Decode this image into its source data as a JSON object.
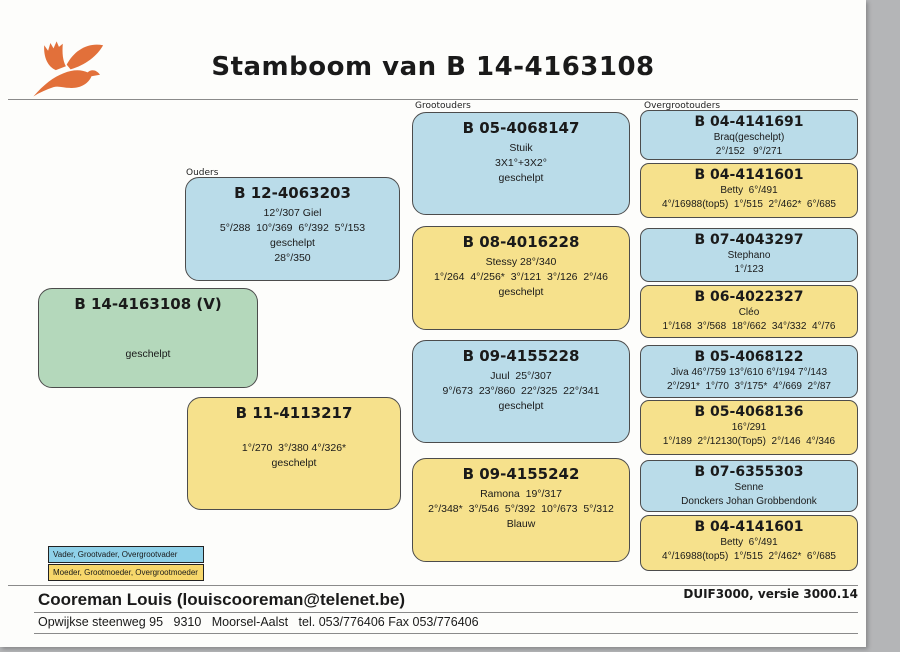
{
  "title": "Stamboom van B 14-4163108",
  "column_labels": {
    "ouders": "Ouders",
    "grootouders": "Grootouders",
    "overgrootouders": "Overgrootouders"
  },
  "subject": {
    "ring": "B 14-4163108 (V)",
    "lines": [
      " ",
      " ",
      "geschelpt"
    ]
  },
  "parents": [
    {
      "role": "vader",
      "ring": "B 12-4063203",
      "lines": [
        "12°/307 Giel",
        "5°/288  10°/369  6°/392  5°/153",
        "geschelpt",
        "28°/350"
      ]
    },
    {
      "role": "moeder",
      "ring": "B 11-4113217",
      "lines": [
        " ",
        "1°/270  3°/380 4°/326*",
        "geschelpt"
      ]
    }
  ],
  "grandparents": [
    {
      "role": "grootvader",
      "ring": "B 05-4068147",
      "lines": [
        "Stuik",
        "3X1°+3X2°",
        "geschelpt"
      ]
    },
    {
      "role": "grootmoeder",
      "ring": "B 08-4016228",
      "lines": [
        "Stessy 28°/340",
        "1°/264  4°/256*  3°/121  3°/126  2°/46",
        "geschelpt"
      ]
    },
    {
      "role": "grootvader",
      "ring": "B 09-4155228",
      "lines": [
        "Juul  25°/307",
        "9°/673  23°/860  22°/325  22°/341",
        "geschelpt"
      ]
    },
    {
      "role": "grootmoeder",
      "ring": "B 09-4155242",
      "lines": [
        "Ramona  19°/317",
        "2°/348*  3°/546  5°/392  10°/673  5°/312",
        "Blauw"
      ]
    }
  ],
  "great_grandparents": [
    {
      "role": "overgrootvader",
      "ring": "B 04-4141691",
      "lines": [
        "Braq(geschelpt)",
        "2°/152   9°/271"
      ]
    },
    {
      "role": "overgrootmoeder",
      "ring": "B 04-4141601",
      "lines": [
        "Betty  6°/491",
        "4°/16988(top5)  1°/515  2°/462*  6°/685"
      ]
    },
    {
      "role": "overgrootvader",
      "ring": "B 07-4043297",
      "lines": [
        "Stephano",
        "1°/123"
      ]
    },
    {
      "role": "overgrootmoeder",
      "ring": "B 06-4022327",
      "lines": [
        "Cléo",
        "1°/168  3°/568  18°/662  34°/332  4°/76"
      ]
    },
    {
      "role": "overgrootvader",
      "ring": "B 05-4068122",
      "lines": [
        "Jiva 46°/759 13°/610 6°/194 7°/143",
        "2°/291*  1°/70  3°/175*  4°/669  2°/87"
      ]
    },
    {
      "role": "overgrootmoeder",
      "ring": "B 05-4068136",
      "lines": [
        "16°/291",
        "1°/189  2°/12130(Top5)  2°/146  4°/346"
      ]
    },
    {
      "role": "overgrootvader",
      "ring": "B 07-6355303",
      "lines": [
        "Senne",
        "Donckers Johan Grobbendonk"
      ]
    },
    {
      "role": "overgrootmoeder",
      "ring": "B 04-4141601",
      "lines": [
        "Betty  6°/491",
        "4°/16988(top5)  1°/515  2°/462*  6°/685"
      ]
    }
  ],
  "legend": {
    "male_label": "Vader, Grootvader, Overgrootvader",
    "female_label": "Moeder, Grootmoeder, Overgrootmoeder"
  },
  "footer": {
    "owner": "Cooreman Louis (louiscooreman@telenet.be)",
    "address": "Opwijkse steenweg 95   9310   Moorsel-Aalst   tel. 053/776406 Fax 053/776406",
    "software": "DUIF3000, versie 3000.14"
  },
  "icons": {
    "logo": "dove-icon"
  },
  "colors": {
    "male_box": "#badce9",
    "female_box": "#f6e18c",
    "subject_box": "#b4d8bb",
    "legend_male": "#8fd1e9",
    "legend_female": "#f7d76b",
    "logo_orange": "#e2703a"
  }
}
